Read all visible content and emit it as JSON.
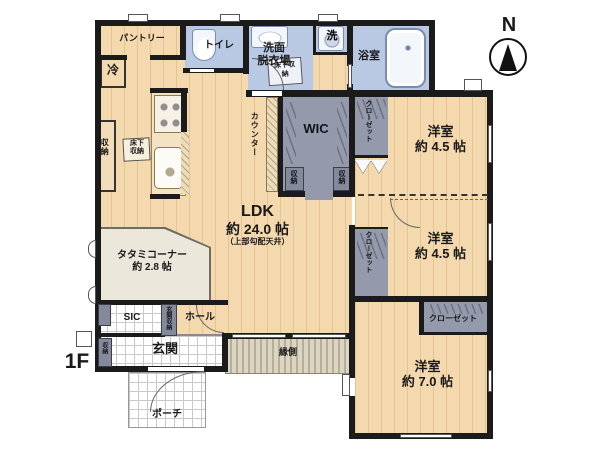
{
  "floor_label": "1F",
  "compass_label": "N",
  "rooms": {
    "ldk": {
      "name": "LDK",
      "size": "約 24.0 帖",
      "note": "（上部勾配天井）"
    },
    "tatami": {
      "name": "タタミコーナー",
      "size": "約 2.8 帖"
    },
    "bedroom_ne": {
      "name": "洋室",
      "size": "約 4.5 帖"
    },
    "bedroom_e": {
      "name": "洋室",
      "size": "約 4.5 帖"
    },
    "bedroom_se": {
      "name": "洋室",
      "size": "約 7.0 帖"
    },
    "pantry": {
      "name": "パントリー"
    },
    "toilet": {
      "name": "トイレ"
    },
    "washroom": {
      "line1": "洗面",
      "line2": "脱衣場"
    },
    "laundry": {
      "name": "洗"
    },
    "bath": {
      "name": "浴室"
    },
    "wic": {
      "name": "WIC"
    },
    "sic": {
      "name": "SIC"
    },
    "hall": {
      "name": "ホール"
    },
    "entrance": {
      "name": "玄関"
    },
    "porch": {
      "name": "ポーチ"
    },
    "engawa": {
      "name": "縁側"
    }
  },
  "storage_labels": {
    "closet": "クローゼット",
    "storage": "収納",
    "underfloor": "床下収納",
    "entrance_storage": "玄関収納",
    "counter": "カウンター",
    "fridge": "冷"
  },
  "colors": {
    "wood_floor": "#f5d9ae",
    "wet_area": "#b9c9e3",
    "closet_gray": "#949aab",
    "tatami": "#ebe7db",
    "wall": "#1b1b1b"
  }
}
